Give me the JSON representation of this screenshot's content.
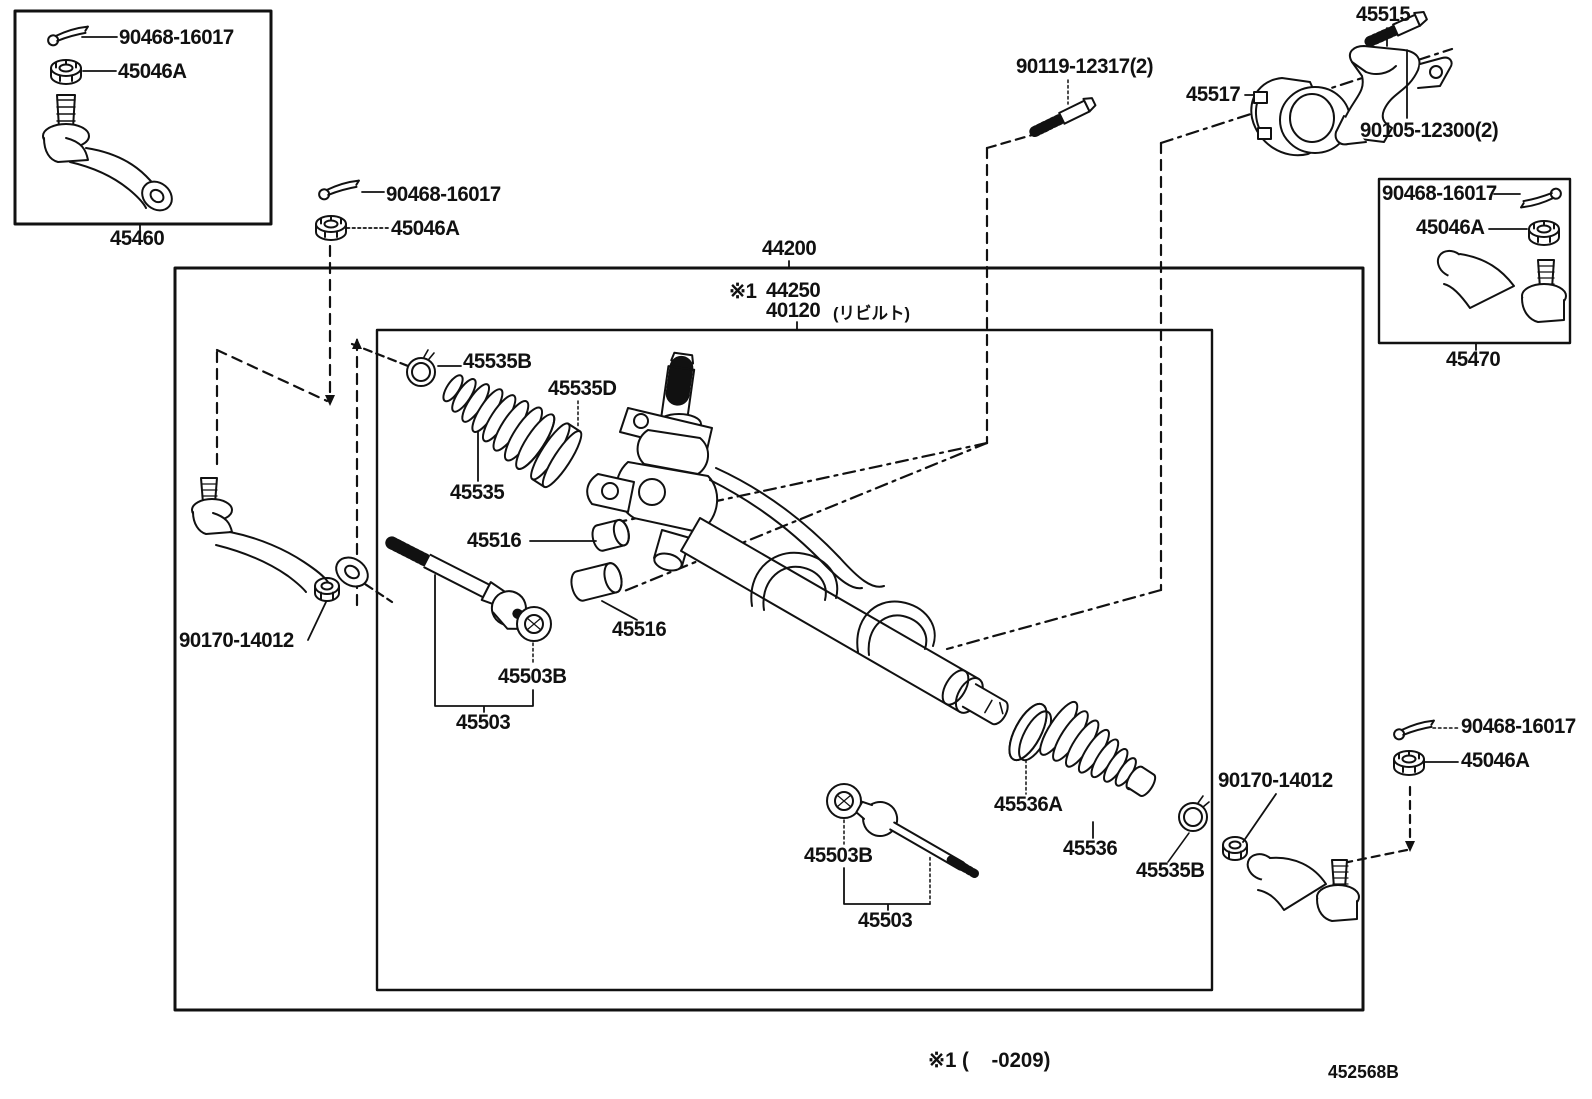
{
  "colors": {
    "ink": "#111111",
    "background": "#ffffff"
  },
  "labels": {
    "box1_pin": "90468-16017",
    "box1_nut": "45046A",
    "box1_part": "45460",
    "pin2": "90468-16017",
    "nut2": "45046A",
    "rack_assy": "44200",
    "rack_sub_prefix": "※1",
    "rack_sub": "44250",
    "rack_core": "40120",
    "rack_core_note": "(リビルト)",
    "mount_bolt": "90119-12317(2)",
    "bracket": "45515",
    "clamp": "45517",
    "bracket_bolt": "90105-12300(2)",
    "boxr_pin": "90468-16017",
    "boxr_nut": "45046A",
    "boxr_part": "45470",
    "boot_l_clip": "45535B",
    "boot_l_clamp": "45535D",
    "boot_l": "45535",
    "bushing_a": "45516",
    "bushing_b": "45516",
    "rod_l_washer": "45503B",
    "rod_l": "45503",
    "tre_l_nut": "90170-14012",
    "boot_r_clamp": "45536A",
    "boot_r": "45536",
    "boot_r_clip": "45535B",
    "rod_r_washer": "45503B",
    "rod_r": "45503",
    "tre_r_nut": "90170-14012",
    "pin3": "90468-16017",
    "nut3": "45046A",
    "footnote": "※1 (    -0209)",
    "sheet_no": "452568B"
  }
}
